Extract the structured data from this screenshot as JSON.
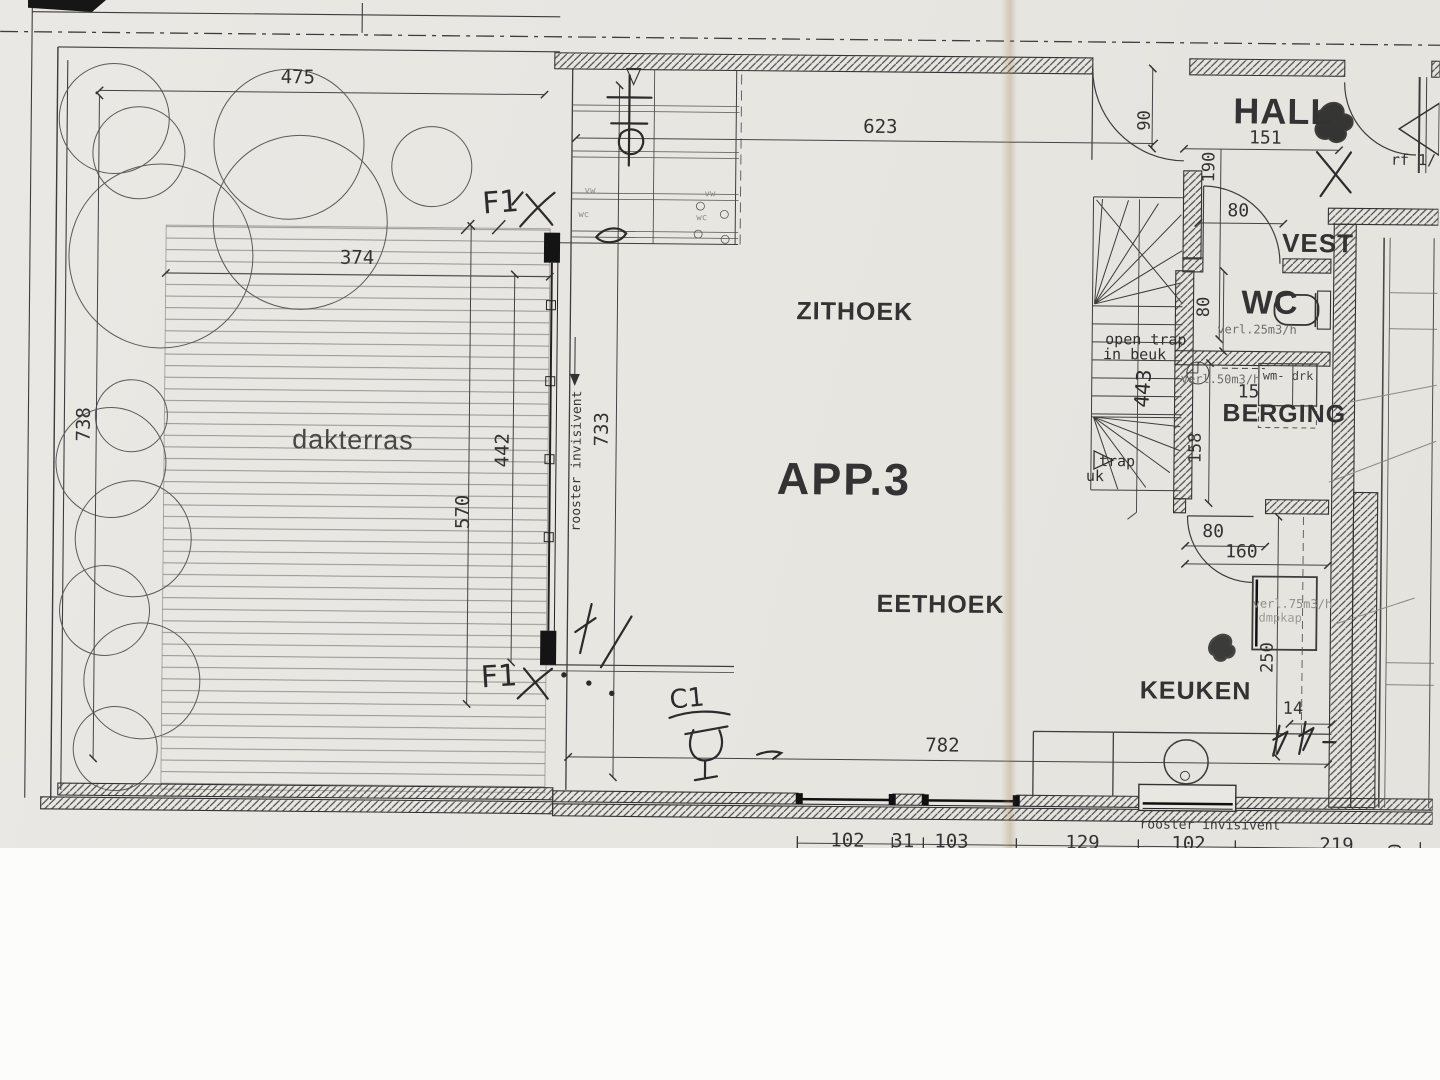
{
  "plan": {
    "apartment_label": "APP.3",
    "rooms": {
      "dakterras": "dakterras",
      "zithoek": "ZITHOEK",
      "eethoek": "EETHOEK",
      "keuken": "KEUKEN",
      "hall": "HALL",
      "vest": "VEST",
      "wc": "WC",
      "berging": "BERGING"
    },
    "dims": {
      "t475": "475",
      "t374": "374",
      "t738": "738",
      "t442": "442",
      "t570": "570",
      "w733": "733",
      "z623": "623",
      "b782": "782",
      "h90": "90",
      "h151": "151",
      "h190": "190",
      "h80": "80",
      "wc80": "80",
      "b158": "158",
      "b15": "15",
      "d80": "80",
      "d160": "160",
      "s250": "250",
      "k14": "14",
      "edge90": "90"
    },
    "bottom_dims": [
      "102",
      "31",
      "103",
      "129",
      "102",
      "219"
    ],
    "notes": {
      "open_trap_l1": "open trap",
      "open_trap_l2": "in beuk",
      "trap": "trap",
      "uk": "uk",
      "vent_wc": "verl.25m3/h",
      "vent_berging": "verl.50m3/h",
      "vent_keuken": "verl.75m3/h",
      "dampkap": "dmpkap",
      "wm_drk": "wm- drk",
      "rooster_window": "rooster invisivent",
      "rooster_bottom": "rooster invisivent",
      "rf": "rf 1/",
      "vw1": "vw",
      "wc1": "wc",
      "vw2": "vw",
      "wc2": "wc"
    },
    "handwritten": {
      "f1_top": "F1",
      "f1_bottom": "F1",
      "c1": "C1",
      "n443": "443"
    }
  }
}
